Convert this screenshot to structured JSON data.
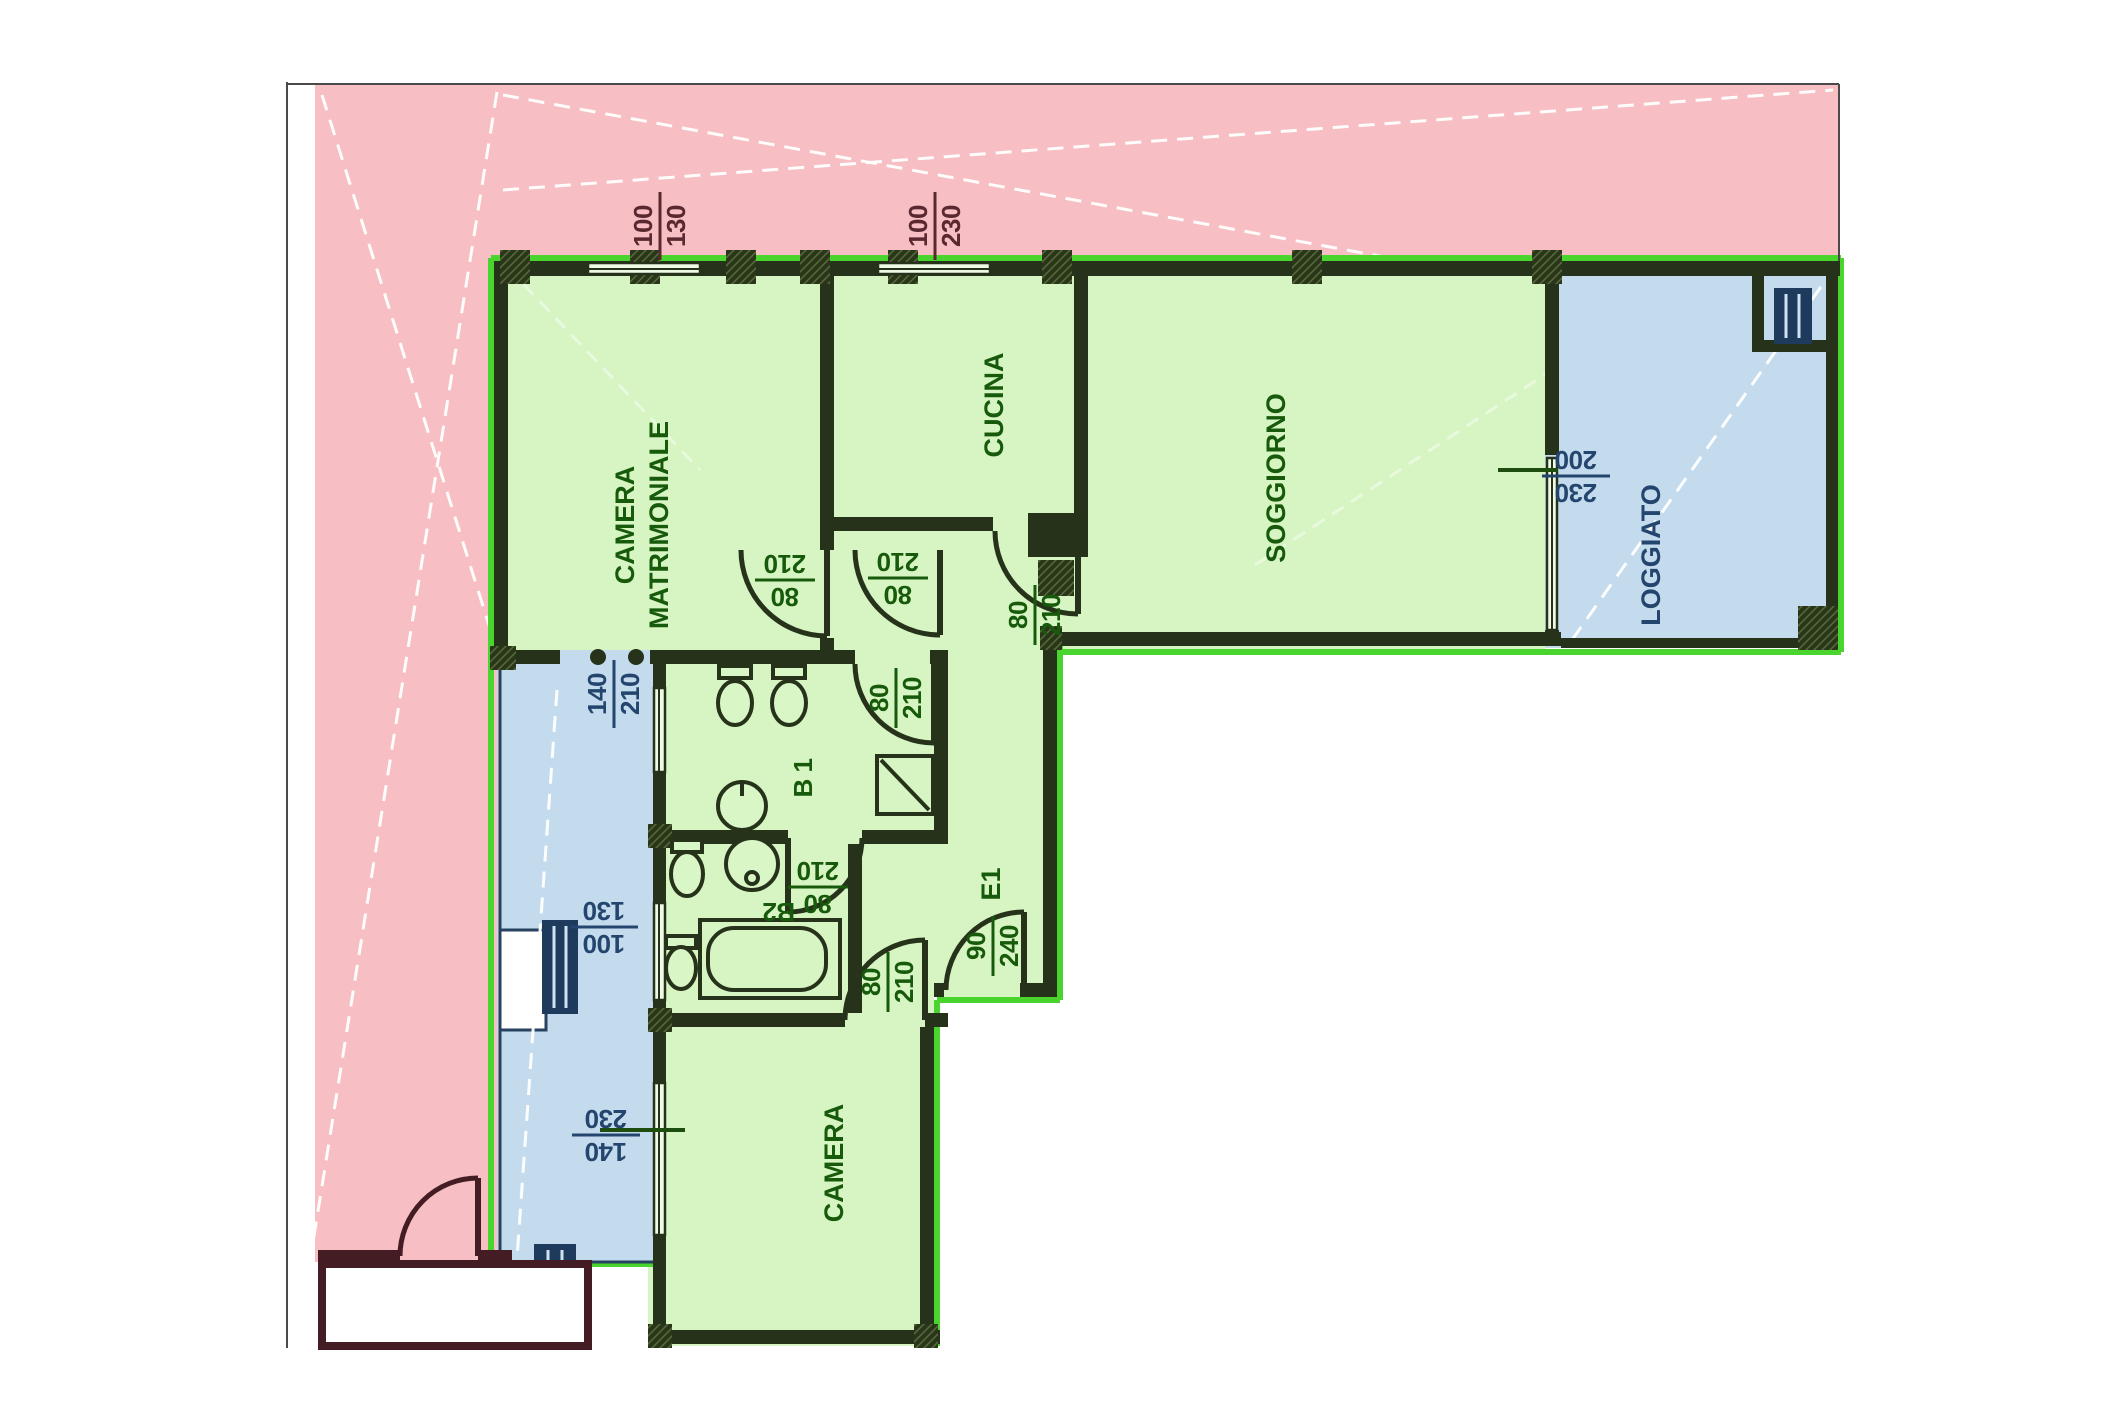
{
  "plan": {
    "title": "apartment floor plan",
    "colors": {
      "exterior_pink": "#f7bfc3",
      "apartment_green": "#d6f5c3",
      "loggia_blue": "#c3dbed",
      "wall_dark": "#26331a",
      "wall_pink_area": "#441d24",
      "outline_bright_green": "#49d42e",
      "text_green": "#175a0b",
      "text_navy": "#24456e",
      "text_maroon": "#5a2830"
    },
    "rooms": {
      "camera_matrimoniale_line1": "CAMERA",
      "camera_matrimoniale_line2": "MATRIMONIALE",
      "cucina": "CUCINA",
      "soggiorno": "SOGGIORNO",
      "loggiato": "LOGGIATO",
      "bagno1": "B 1",
      "bagno2": "B2",
      "camera": "CAMERA",
      "entrance": "E1"
    },
    "dimensions": {
      "window_top_left": {
        "w": "100",
        "h": "130"
      },
      "window_top_center": {
        "w": "100",
        "h": "230"
      },
      "window_soggiorno": {
        "w": "230",
        "h": "200"
      },
      "window_camera_matrimoniale": {
        "w": "140",
        "h": "210"
      },
      "window_bagno": {
        "w": "100",
        "h": "130"
      },
      "window_camera": {
        "w": "140",
        "h": "230"
      },
      "door_cucina": {
        "w": "80",
        "h": "210"
      },
      "door_camera_matrimoniale": {
        "w": "80",
        "h": "210"
      },
      "door_disimpegno": {
        "w": "80",
        "h": "210"
      },
      "door_bagno1": {
        "w": "80",
        "h": "210"
      },
      "door_bagno2": {
        "w": "80",
        "h": "210"
      },
      "door_camera": {
        "w": "80",
        "h": "210"
      },
      "door_entrance": {
        "w": "90",
        "h": "240"
      }
    }
  }
}
